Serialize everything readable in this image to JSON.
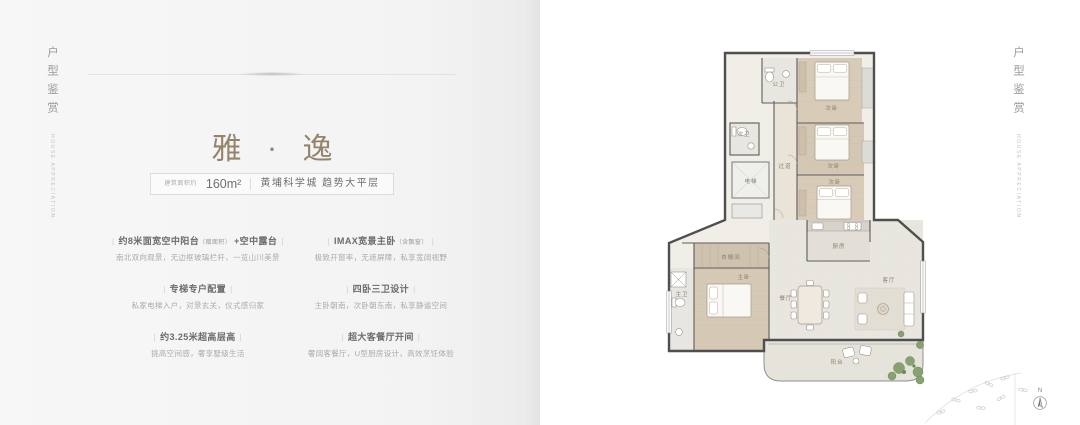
{
  "left_panel": {
    "vertical_title": "户型鉴赏",
    "vertical_subtitle": "HOUSE APPRECIATION",
    "title": "雅 · 逸",
    "badge": {
      "area_label": "建筑面积约",
      "area_value": "160m²",
      "location": "黄埔科学城  趋势大平层"
    },
    "features": {
      "pipe": "|",
      "items": [
        {
          "title": "约8米面宽空中阳台",
          "note": "（赠面积）",
          "suffix": " +空中露台",
          "subtitle": "南北双向观景，无边框玻璃栏杆，一览山川美景"
        },
        {
          "title": "IMAX宽景主卧",
          "note": "（含飘窗）",
          "suffix": "",
          "subtitle": "极致开窗率，无遮屏障，私享宽阔视野"
        },
        {
          "title": "专梯专户配置",
          "note": "",
          "suffix": "",
          "subtitle": "私家电梯入户，对景玄关，仪式感归家"
        },
        {
          "title": "四卧三卫设计",
          "note": "",
          "suffix": "",
          "subtitle": "主卧朝南，次卧朝东南，私享静谧空间"
        },
        {
          "title": "约3.25米超高层高",
          "note": "",
          "suffix": "",
          "subtitle": "挑高空间感，奢享墅级生活"
        },
        {
          "title": "超大客餐厅开间",
          "note": "",
          "suffix": "",
          "subtitle": "奢阔客餐厅，U型厨房设计，高效烹饪体验"
        }
      ]
    }
  },
  "right_panel": {
    "vertical_title": "户型鉴赏",
    "vertical_subtitle": "HOUSE APPRECIATION",
    "compass_label": "N",
    "floorplan_labels": {
      "bath_public": "公卫",
      "bedroom_a": "次卧",
      "bedroom_b": "次卧",
      "bedroom_c": "次卧",
      "corridor": "过道",
      "bath_secondary": "次卫",
      "elevator": "电梯",
      "closet": "衣帽间",
      "master_bedroom": "主卧",
      "master_bath": "主卫",
      "kitchen": "厨房",
      "dining": "餐厅",
      "living": "客厅",
      "balcony": "阳台"
    }
  },
  "colors": {
    "accent_title": "#95836a",
    "left_page_bg": "#f4f4f4",
    "wall": "#4f4f4f",
    "wood_floor": "#d6c9b6",
    "tile_floor": "#e9e6e0",
    "balcony_floor": "#e6e3db",
    "plant_green": "#87a173"
  }
}
